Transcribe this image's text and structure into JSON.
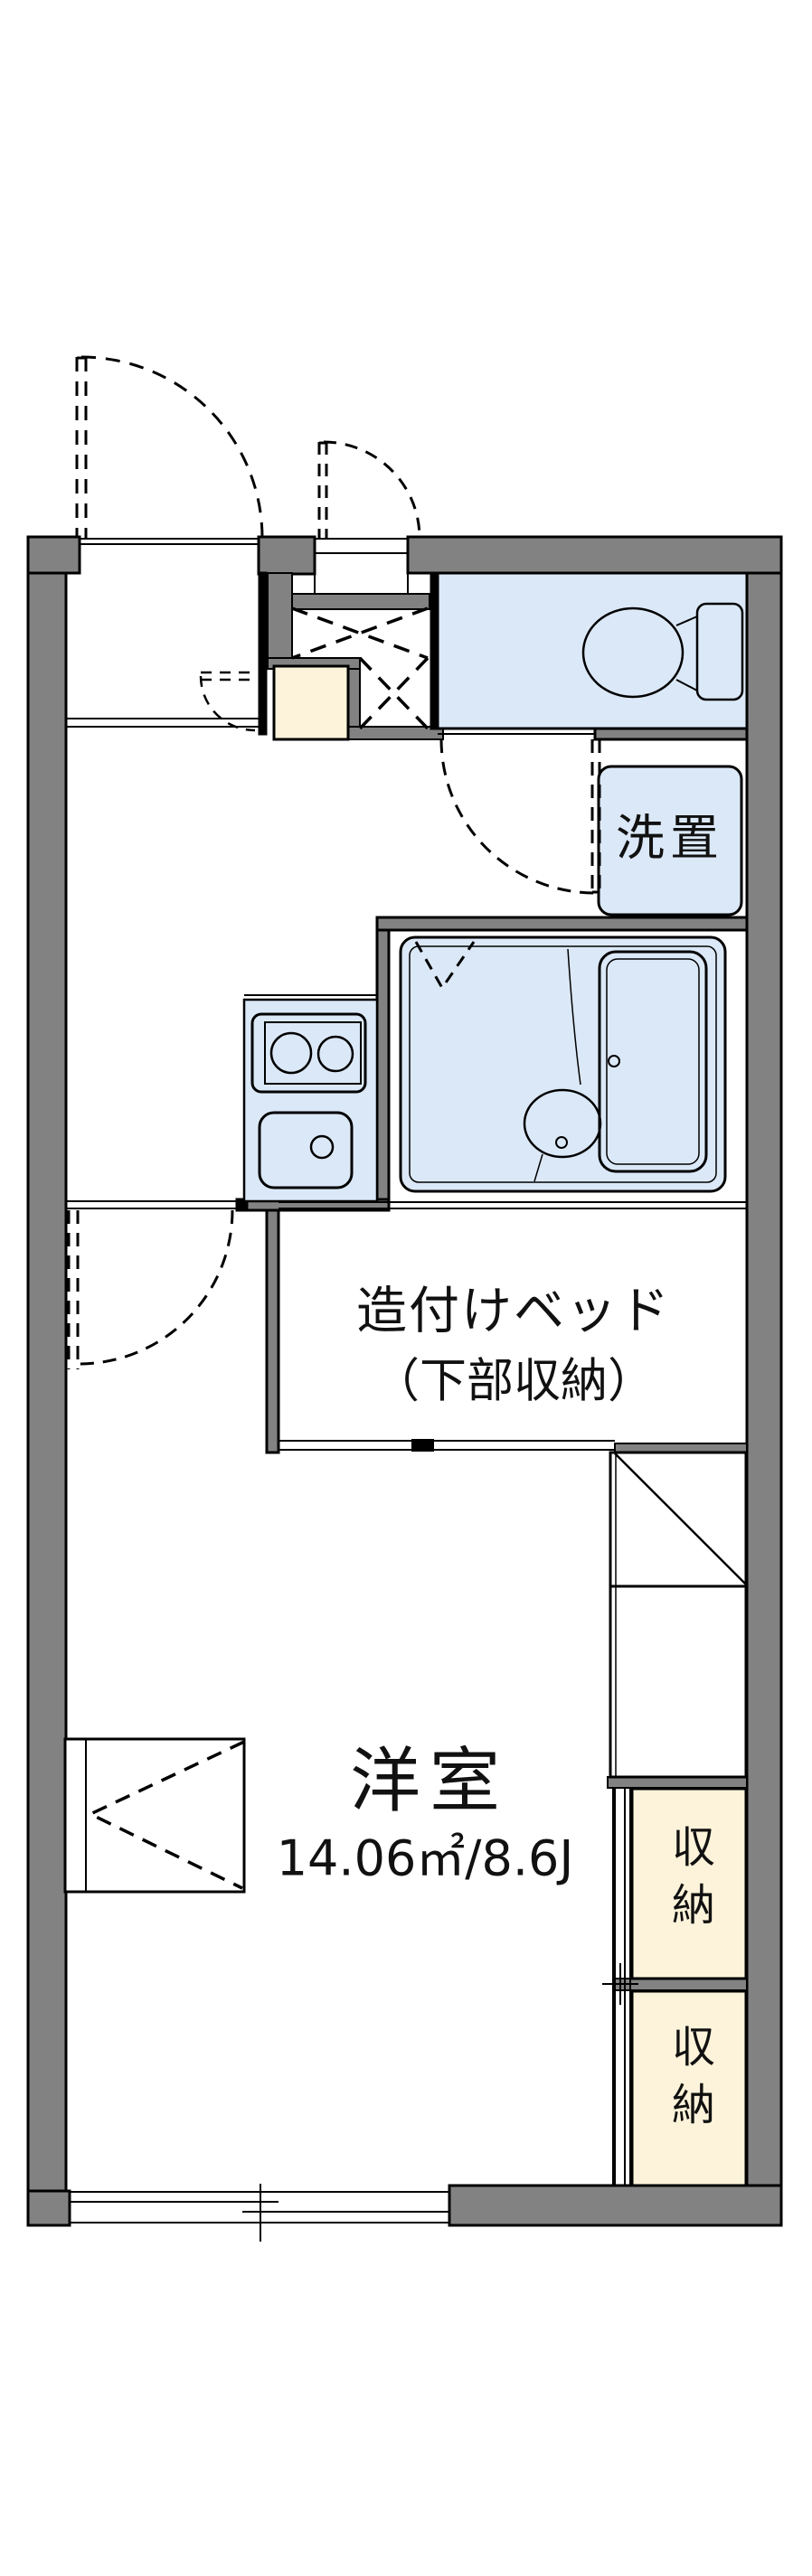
{
  "floor_plan": {
    "rooms": {
      "western_room": {
        "name": "洋室",
        "area": "14.06㎡/8.6J"
      },
      "built_in_bed": {
        "label_line1": "造付けベッド",
        "label_line2": "（下部収納）"
      },
      "laundry_space": {
        "label": "洗置"
      },
      "closet_upper": {
        "label": "収納"
      },
      "closet_lower": {
        "label": "収納"
      }
    },
    "colors": {
      "wall": "#828282",
      "wet_area_fill": "#dbe8f7",
      "storage_fill": "#fdf3da",
      "line": "#000000",
      "background": "#ffffff"
    }
  }
}
